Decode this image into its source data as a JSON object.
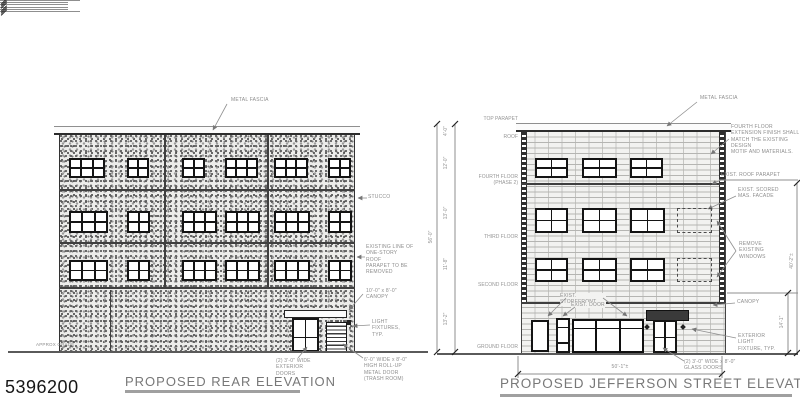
{
  "sheet": {
    "number": "5396200"
  },
  "rear_elevation": {
    "title": "PROPOSED REAR ELEVATION",
    "callouts": {
      "metal_fascia": "METAL FASCIA",
      "stucco": "STUCCO",
      "existing_parapet": "EXISTING LINE OF\nONE-STORY ROOF\nPARAPET TO BE\nREMOVED",
      "canopy": "10'-0\" x 8'-0\"\nCANOPY",
      "light_fixtures": "LIGHT\nFIXTURES, TYP.",
      "exterior_doors": "(2) 3'-0\" WIDE\nEXTERIOR DOORS",
      "rollup_door": "6'-0\" WIDE x 8'-0\"\nHIGH ROLL-UP\nMETAL DOOR\n(TRASH ROOM)",
      "approx_grade": "APPROX GRADE"
    },
    "windows": {
      "rows": [
        {
          "y": 158,
          "h": 20,
          "units": [
            {
              "x": 69,
              "w": 36,
              "panes": 3
            },
            {
              "x": 127,
              "w": 22,
              "panes": 2
            },
            {
              "x": 182,
              "w": 23,
              "panes": 2
            },
            {
              "x": 225,
              "w": 33,
              "panes": 3
            },
            {
              "x": 274,
              "w": 34,
              "panes": 3
            },
            {
              "x": 328,
              "w": 23,
              "panes": 2
            }
          ]
        },
        {
          "y": 211,
          "h": 22,
          "units": [
            {
              "x": 69,
              "w": 39,
              "panes": 3
            },
            {
              "x": 127,
              "w": 23,
              "panes": 2
            },
            {
              "x": 182,
              "w": 35,
              "panes": 3
            },
            {
              "x": 225,
              "w": 35,
              "panes": 3
            },
            {
              "x": 274,
              "w": 36,
              "panes": 3
            },
            {
              "x": 328,
              "w": 24,
              "panes": 2
            }
          ]
        },
        {
          "y": 260,
          "h": 21,
          "units": [
            {
              "x": 69,
              "w": 39,
              "panes": 3
            },
            {
              "x": 127,
              "w": 23,
              "panes": 2
            },
            {
              "x": 182,
              "w": 35,
              "panes": 3
            },
            {
              "x": 225,
              "w": 35,
              "panes": 3
            },
            {
              "x": 274,
              "w": 36,
              "panes": 3
            },
            {
              "x": 328,
              "w": 24,
              "panes": 2
            }
          ]
        }
      ]
    }
  },
  "street_elevation": {
    "title": "PROPOSED JEFFERSON STREET ELEVATION",
    "callouts": {
      "metal_fascia": "METAL FASCIA",
      "fourth_floor_note": "FOURTH FLOOR\nEXTENSION FINISH SHALL\nMATCH THE EXISTING DESIGN\nMOTIF AND MATERIALS.",
      "exist_roof_parapet": "EXIST. ROOF PARAPET",
      "exist_scored": "EXIST. SCORED\nMAS. FACADE",
      "remove_windows": "REMOVE\nEXISTING\nWINDOWS",
      "canopy": "CANOPY",
      "exterior_light": "EXTERIOR LIGHT\nFIXTURE, TYP.",
      "glass_doors": "(2) 3'-0\" WIDE x 8'-0\"\nGLASS DOORS",
      "exist_storefront": "EXIST. STOREFRONT",
      "exist_door": "EXIST. DOOR"
    },
    "levels": [
      {
        "label": "TOP PARAPET",
        "y": 124
      },
      {
        "label": "ROOF",
        "y": 142
      },
      {
        "label": "FOURTH FLOOR\n(PHASE 2)",
        "y": 188
      },
      {
        "label": "THIRD FLOOR",
        "y": 242
      },
      {
        "label": "SECOND FLOOR",
        "y": 290
      },
      {
        "label": "GROUND FLOOR",
        "y": 352
      }
    ],
    "story_dims": [
      {
        "text": "4'-0\"",
        "y": 133
      },
      {
        "text": "12'-0\"",
        "y": 165
      },
      {
        "text": "13'-0\"",
        "y": 215
      },
      {
        "text": "11'-8\"",
        "y": 266
      },
      {
        "text": "13'-2\"",
        "y": 321
      }
    ],
    "overall_height_dim": "56'-0\"",
    "width_dim": "50'-1\"±",
    "storefront_height_dim": "14'-1\"",
    "right_overall_dim": "40'-2\"±",
    "windows": {
      "rows": [
        {
          "y": 158,
          "h": 20,
          "units": [
            {
              "x": 535,
              "w": 33,
              "panes": 2
            },
            {
              "x": 582,
              "w": 35,
              "panes": 2
            },
            {
              "x": 630,
              "w": 33,
              "panes": 2
            }
          ]
        },
        {
          "y": 208,
          "h": 25,
          "units": [
            {
              "x": 535,
              "w": 33,
              "panes": 2
            },
            {
              "x": 582,
              "w": 35,
              "panes": 2
            },
            {
              "x": 630,
              "w": 35,
              "panes": 2
            }
          ],
          "dashed": {
            "x": 677,
            "w": 35
          }
        },
        {
          "y": 258,
          "h": 24,
          "units": [
            {
              "x": 535,
              "w": 33,
              "panes": 2
            },
            {
              "x": 582,
              "w": 35,
              "panes": 2
            },
            {
              "x": 630,
              "w": 35,
              "panes": 2
            }
          ],
          "dashed": {
            "x": 677,
            "w": 35
          }
        }
      ]
    }
  }
}
